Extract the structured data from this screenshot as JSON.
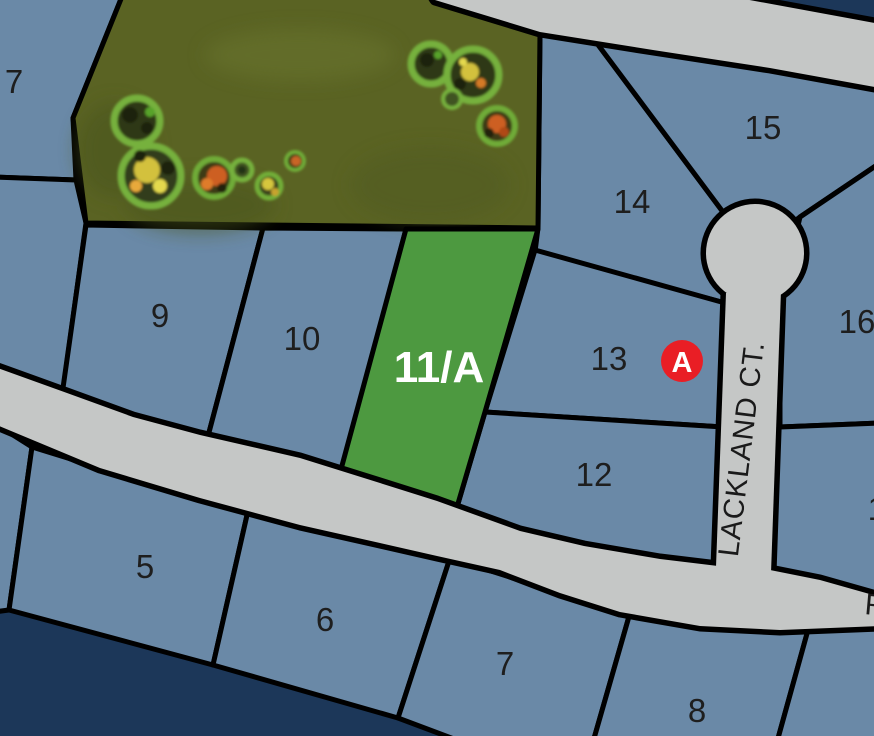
{
  "colors": {
    "background": "#1c3759",
    "lot_fill": "#6a89a7",
    "outline": "#000000",
    "road_fill": "#c5c7c6",
    "highlight_fill": "#4d9940",
    "wooded_fill": "#5a6323",
    "label_color": "#1e1e1e",
    "street_label_color": "#1a1a1a",
    "highlight_label_color": "#ffffff",
    "marker_fill": "#e91e25",
    "marker_label_color": "#ffffff"
  },
  "street": {
    "name": "LACKLAND CT.",
    "edge_partial_label": "R"
  },
  "marker": {
    "label": "A"
  },
  "lots": {
    "lot7_upper": {
      "label": "7"
    },
    "lot9": {
      "label": "9"
    },
    "lot10": {
      "label": "10"
    },
    "lot11a": {
      "label": "11/A"
    },
    "lot12": {
      "label": "12"
    },
    "lot13": {
      "label": "13"
    },
    "lot14": {
      "label": "14"
    },
    "lot15": {
      "label": "15"
    },
    "lot16": {
      "label": "16"
    },
    "lot17_partial": {
      "label": "17"
    },
    "lot5": {
      "label": "5"
    },
    "lot6": {
      "label": "6"
    },
    "lot7_lower": {
      "label": "7"
    },
    "lot8": {
      "label": "8"
    }
  }
}
